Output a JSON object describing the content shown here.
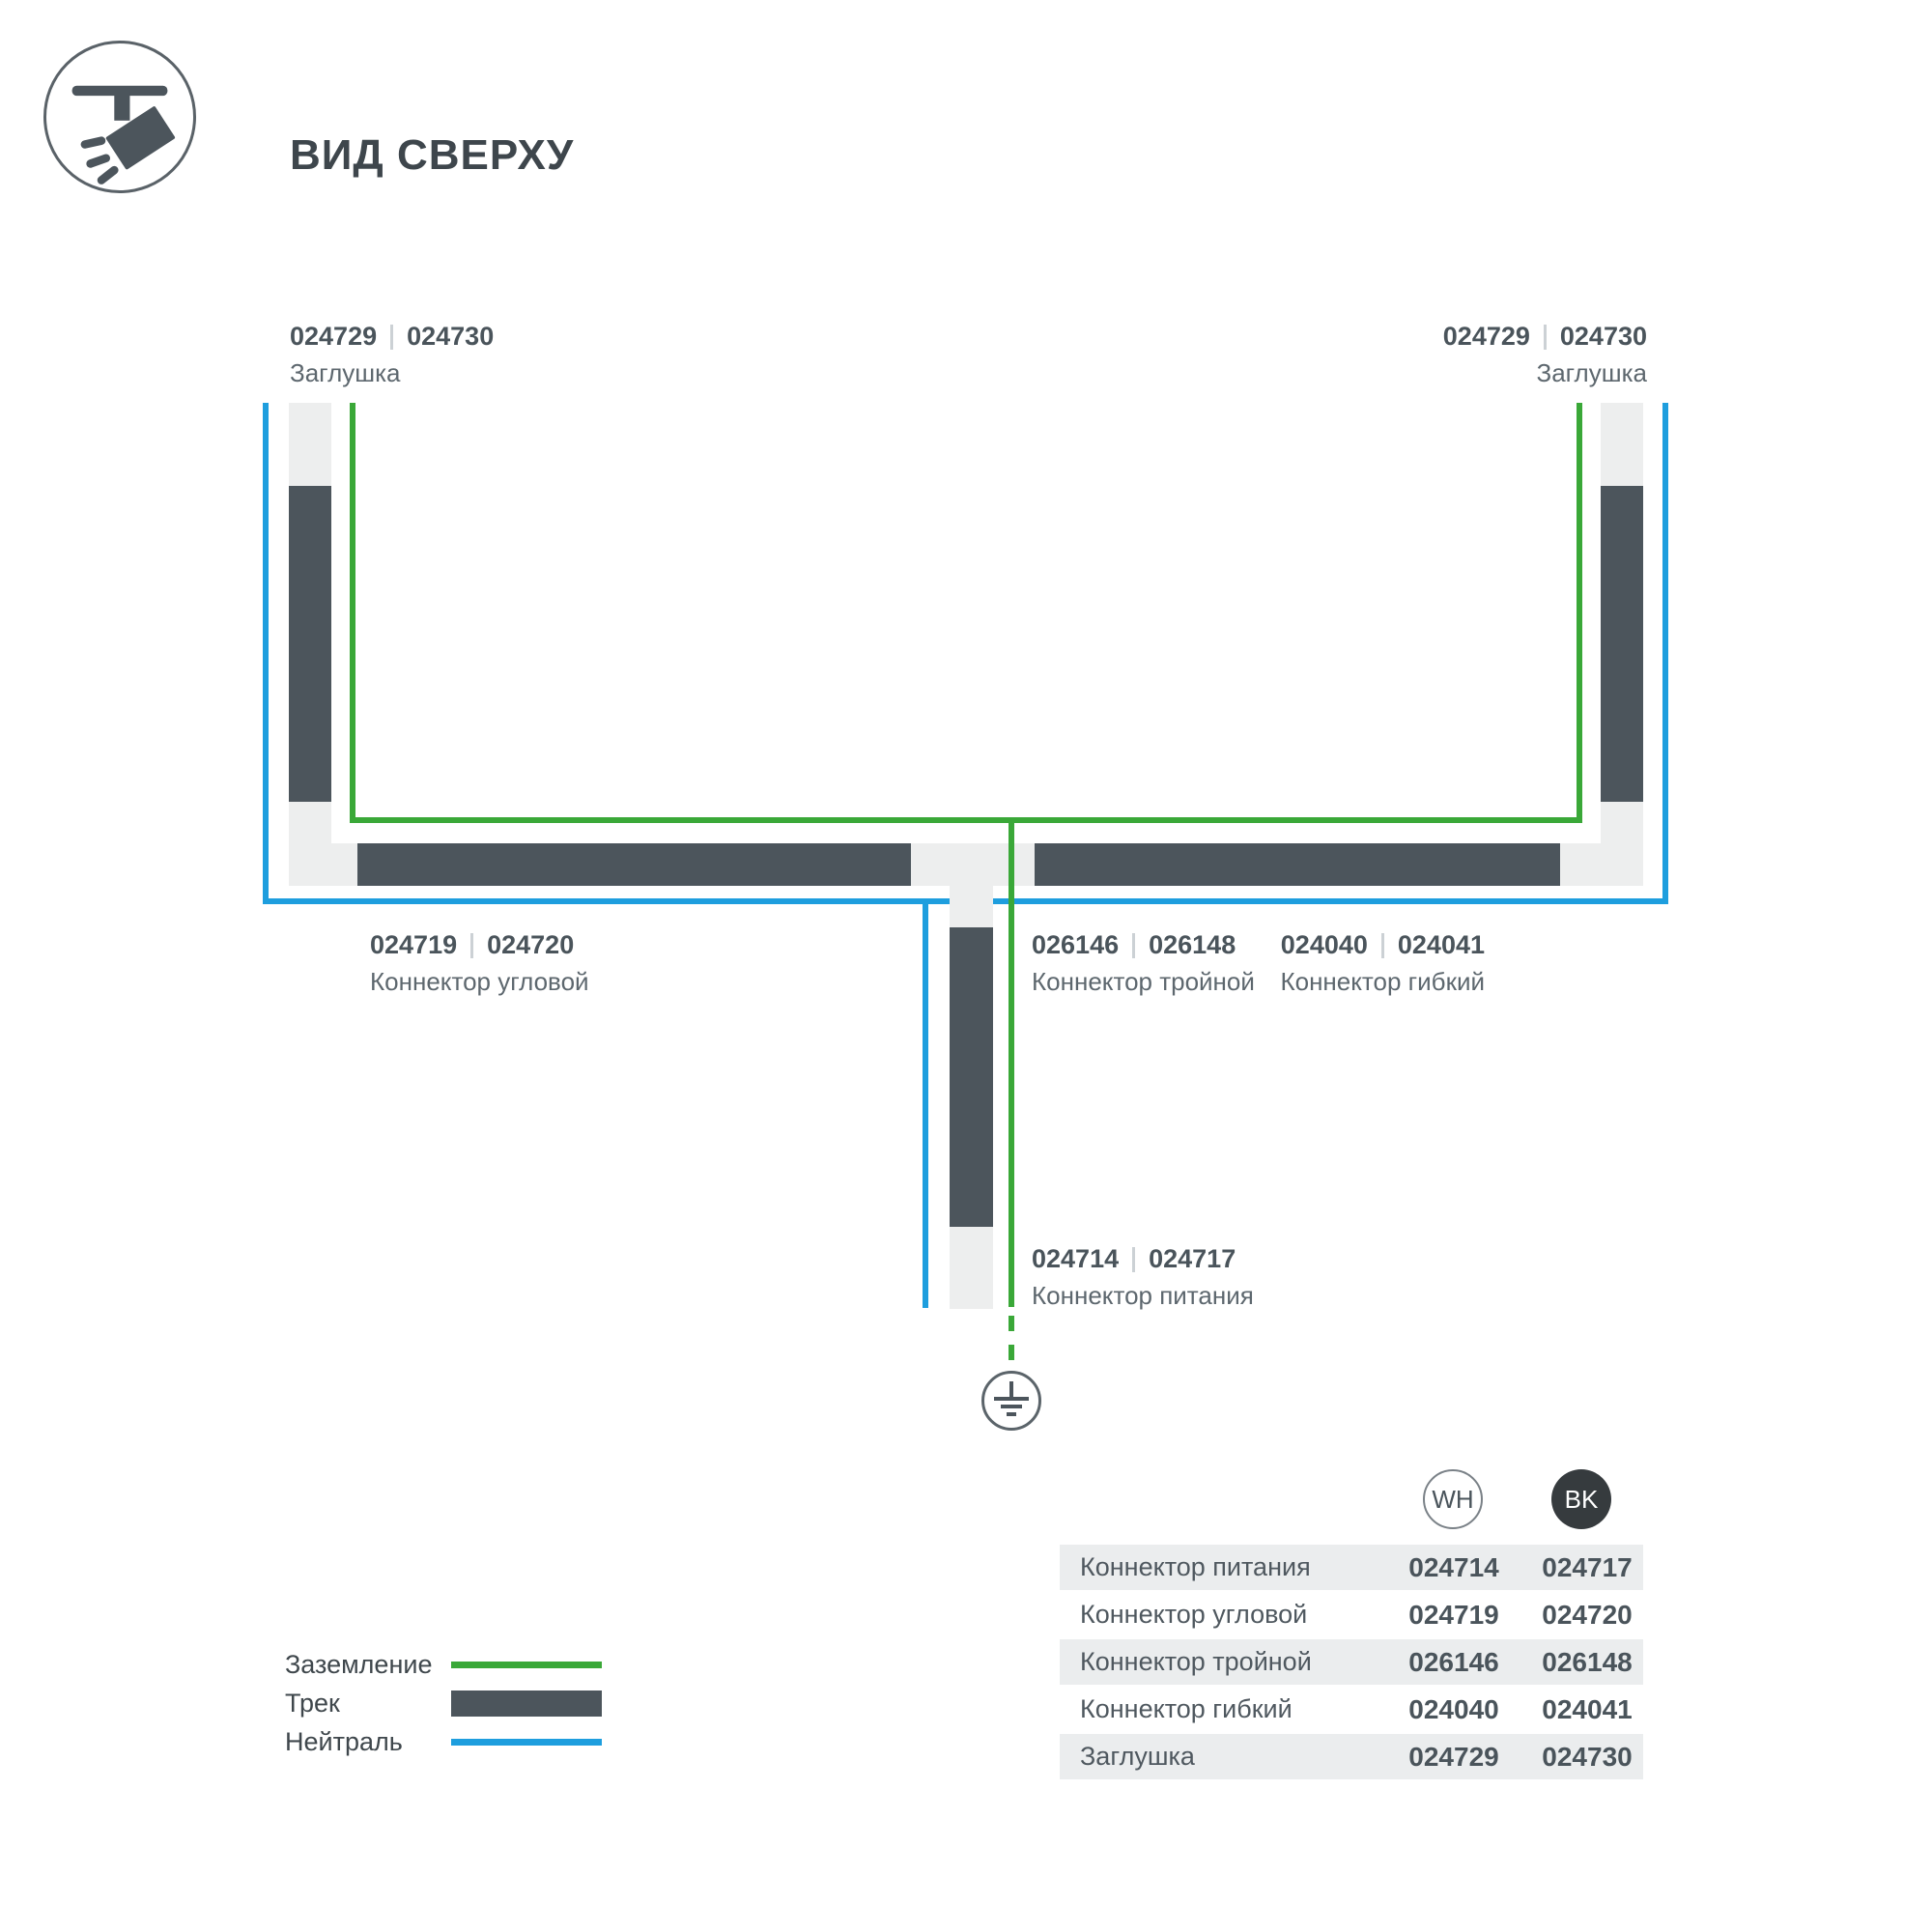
{
  "header": {
    "title": "ВИД СВЕРХУ"
  },
  "diagram": {
    "labels": {
      "cap_left": {
        "codes": [
          "024729",
          "024730"
        ],
        "name": "Заглушка"
      },
      "cap_right": {
        "codes": [
          "024729",
          "024730"
        ],
        "name": "Заглушка"
      },
      "corner": {
        "codes": [
          "024719",
          "024720"
        ],
        "name": "Коннектор угловой"
      },
      "triple": {
        "codes": [
          "026146",
          "026148"
        ],
        "name": "Коннектор тройной"
      },
      "flex": {
        "codes": [
          "024040",
          "024041"
        ],
        "name": "Коннектор гибкий"
      },
      "power": {
        "codes": [
          "024714",
          "024717"
        ],
        "name": "Коннектор питания"
      }
    },
    "colors": {
      "ground_green": "#3aa838",
      "neutral_blue": "#1e9ede",
      "track_dark": "#4c555c",
      "track_light": "#edeeee"
    }
  },
  "legend": {
    "items": [
      {
        "label": "Заземление",
        "type": "ground"
      },
      {
        "label": "Трек",
        "type": "track"
      },
      {
        "label": "Нейтраль",
        "type": "neutral"
      }
    ]
  },
  "table": {
    "columns": [
      {
        "code": "WH"
      },
      {
        "code": "BK"
      }
    ],
    "rows": [
      {
        "label": "Коннектор питания",
        "wh": "024714",
        "bk": "024717"
      },
      {
        "label": "Коннектор угловой",
        "wh": "024719",
        "bk": "024720"
      },
      {
        "label": "Коннектор тройной",
        "wh": "026146",
        "bk": "026148"
      },
      {
        "label": "Коннектор гибкий",
        "wh": "024040",
        "bk": "024041"
      },
      {
        "label": "Заглушка",
        "wh": "024729",
        "bk": "024730"
      }
    ]
  }
}
